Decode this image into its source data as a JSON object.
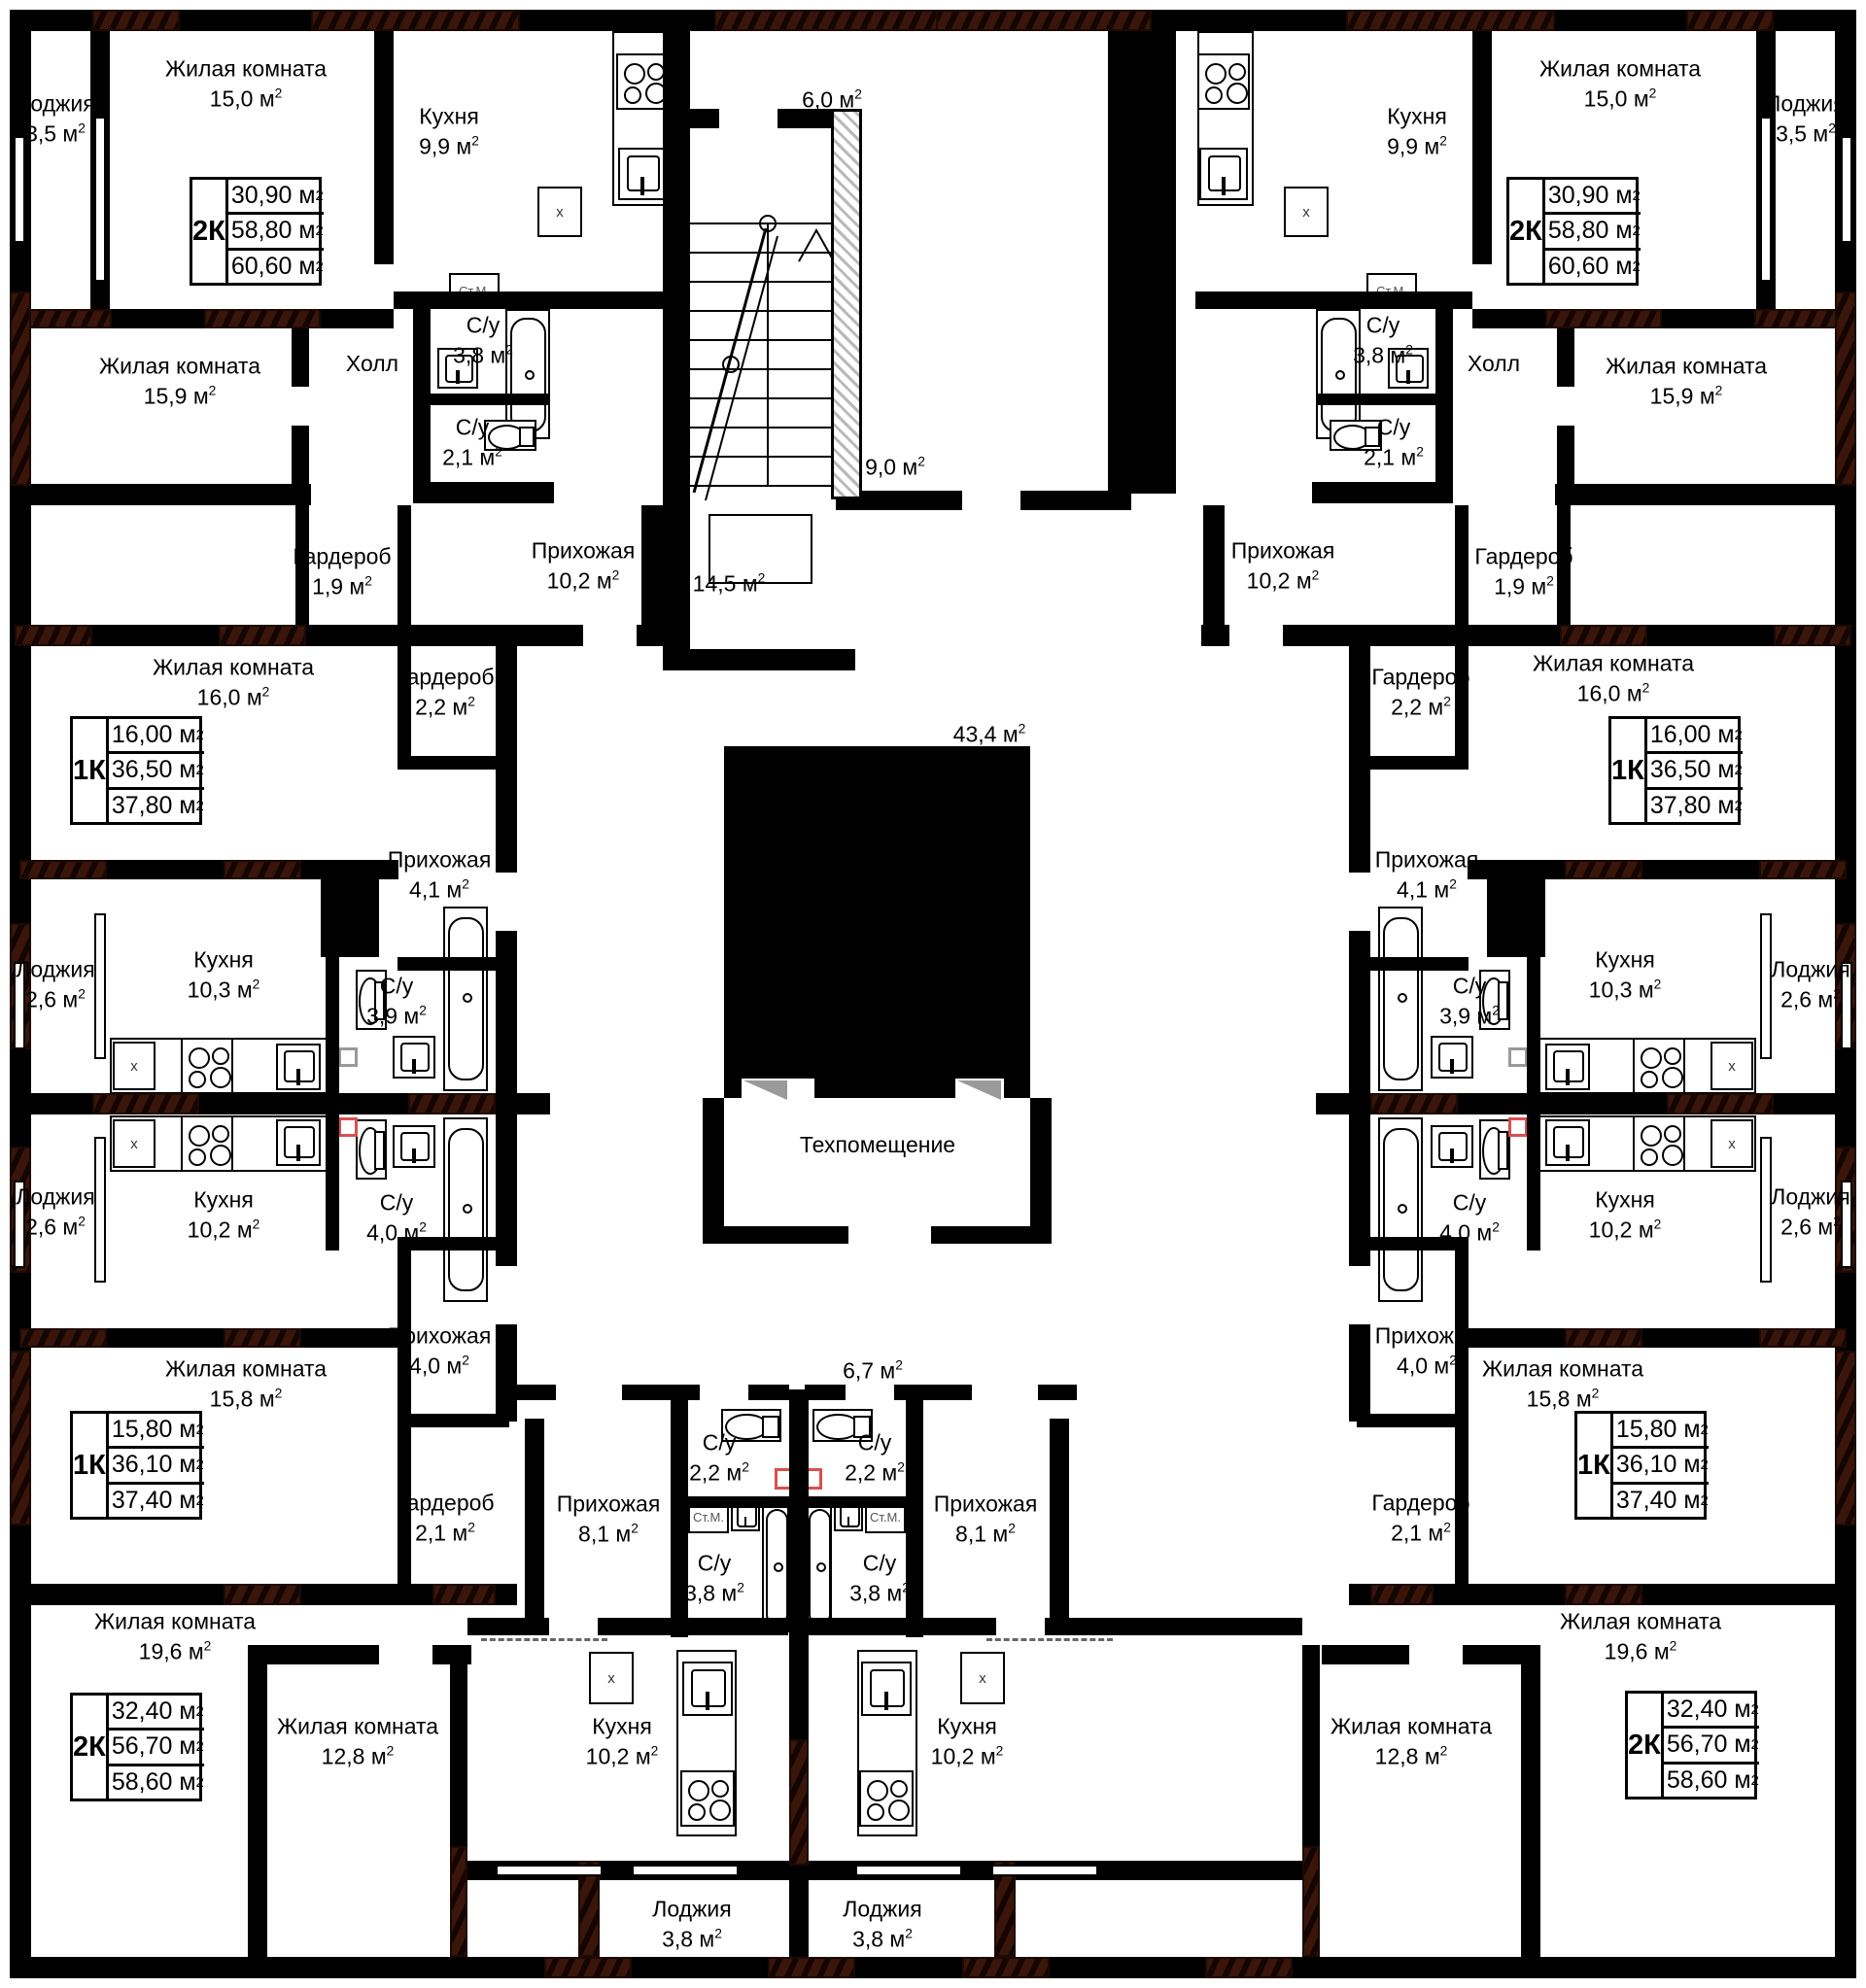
{
  "plan": {
    "fixture_labels": {
      "washing_machine": "Ст.М.",
      "appliance_mark": "x"
    },
    "colors": {
      "wall": "#000000",
      "hatch": "#3a150a",
      "red_highlight": "#d94f4f",
      "paper": "#ffffff"
    },
    "rooms": {
      "tl_loggia": {
        "name": "Лоджия",
        "area": "3,5 м²"
      },
      "tl_living1": {
        "name": "Жилая комната",
        "area": "15,0 м²"
      },
      "tl_kitchen": {
        "name": "Кухня",
        "area": "9,9 м²"
      },
      "tl_living2": {
        "name": "Жилая комната",
        "area": "15,9 м²"
      },
      "tl_hall": {
        "name": "Холл",
        "area": ""
      },
      "tl_su38": {
        "name": "С/у",
        "area": "3,8 м²"
      },
      "tl_su21": {
        "name": "С/у",
        "area": "2,1 м²"
      },
      "tl_garderob": {
        "name": "Гардероб",
        "area": "1,9 м²"
      },
      "tl_prihozhaya": {
        "name": "Прихожая",
        "area": "10,2 м²"
      },
      "ml_living": {
        "name": "Жилая комната",
        "area": "16,0 м²"
      },
      "ml_garderob": {
        "name": "Гардероб",
        "area": "2,2 м²"
      },
      "ml_prihozhaya": {
        "name": "Прихожая",
        "area": "4,1 м²"
      },
      "ml_loggia_a": {
        "name": "Лоджия",
        "area": "2,6 м²"
      },
      "ml_kitchen_a": {
        "name": "Кухня",
        "area": "10,3 м²"
      },
      "ml_su39": {
        "name": "С/у",
        "area": "3,9 м²"
      },
      "ml_loggia_b": {
        "name": "Лоджия",
        "area": "2,6 м²"
      },
      "ml_kitchen_b": {
        "name": "Кухня",
        "area": "10,2 м²"
      },
      "ml_su40": {
        "name": "С/у",
        "area": "4,0 м²"
      },
      "bl_prihozhaya40": {
        "name": "Прихожая",
        "area": "4,0 м²"
      },
      "bl_living158": {
        "name": "Жилая комната",
        "area": "15,8 м²"
      },
      "bl_garderob21": {
        "name": "Гардероб",
        "area": "2,1 м²"
      },
      "bl_living196": {
        "name": "Жилая комната",
        "area": "19,6 м²"
      },
      "bl_living128": {
        "name": "Жилая комната",
        "area": "12,8 м²"
      },
      "bl_kitchen102": {
        "name": "Кухня",
        "area": "10,2 м²"
      },
      "bl_prihozhaya81": {
        "name": "Прихожая",
        "area": "8,1 м²"
      },
      "bl_su22": {
        "name": "С/у",
        "area": "2,2 м²"
      },
      "bl_su38": {
        "name": "С/у",
        "area": "3,8 м²"
      },
      "bl_loggia38": {
        "name": "Лоджия",
        "area": "3,8 м²"
      },
      "c_60": {
        "name": "",
        "area": "6,0 м²"
      },
      "c_90": {
        "name": "",
        "area": "9,0 м²"
      },
      "c_145": {
        "name": "",
        "area": "14,5 м²"
      },
      "c_434": {
        "name": "",
        "area": "43,4 м²"
      },
      "c_tech": {
        "name": "Техпомещение",
        "area": ""
      },
      "c_67": {
        "name": "",
        "area": "6,7 м²"
      },
      "tr_kitchen": {
        "name": "Кухня",
        "area": "9,9 м²"
      },
      "tr_living1": {
        "name": "Жилая комната",
        "area": "15,0 м²"
      },
      "tr_loggia": {
        "name": "Лоджия",
        "area": "3,5 м²"
      },
      "tr_su38": {
        "name": "С/у",
        "area": "3,8 м²"
      },
      "tr_su21": {
        "name": "С/у",
        "area": "2,1 м²"
      },
      "tr_hall": {
        "name": "Холл",
        "area": ""
      },
      "tr_living2": {
        "name": "Жилая комната",
        "area": "15,9 м²"
      },
      "tr_prihozhaya": {
        "name": "Прихожая",
        "area": "10,2 м²"
      },
      "tr_garderob": {
        "name": "Гардероб",
        "area": "1,9 м²"
      },
      "mr_garderob": {
        "name": "Гардероб",
        "area": "2,2 м²"
      },
      "mr_living": {
        "name": "Жилая комната",
        "area": "16,0 м²"
      },
      "mr_prihozhaya": {
        "name": "Прихожая",
        "area": "4,1 м²"
      },
      "mr_su39": {
        "name": "С/у",
        "area": "3,9 м²"
      },
      "mr_kitchen_a": {
        "name": "Кухня",
        "area": "10,3 м²"
      },
      "mr_loggia_a": {
        "name": "Лоджия",
        "area": "2,6 м²"
      },
      "mr_su40": {
        "name": "С/у",
        "area": "4,0 м²"
      },
      "mr_kitchen_b": {
        "name": "Кухня",
        "area": "10,2 м²"
      },
      "mr_loggia_b": {
        "name": "Лоджия",
        "area": "2,6 м²"
      },
      "br_prihozhaya40": {
        "name": "Прихожая",
        "area": "4,0 м²"
      },
      "br_living158": {
        "name": "Жилая комната",
        "area": "15,8 м²"
      },
      "br_garderob21": {
        "name": "Гардероб",
        "area": "2,1 м²"
      },
      "br_living196": {
        "name": "Жилая комната",
        "area": "19,6 м²"
      },
      "br_living128": {
        "name": "Жилая комната",
        "area": "12,8 м²"
      },
      "br_kitchen102": {
        "name": "Кухня",
        "area": "10,2 м²"
      },
      "br_prihozhaya81": {
        "name": "Прихожая",
        "area": "8,1 м²"
      },
      "br_su22": {
        "name": "С/у",
        "area": "2,2 м²"
      },
      "br_su38": {
        "name": "С/у",
        "area": "3,8 м²"
      },
      "br_loggia38": {
        "name": "Лоджия",
        "area": "3,8 м²"
      }
    },
    "apartments": {
      "tl2k": {
        "type": "2К",
        "areas": [
          "30,90 м²",
          "58,80 м²",
          "60,60 м²"
        ]
      },
      "tr2k": {
        "type": "2К",
        "areas": [
          "30,90 м²",
          "58,80 м²",
          "60,60 м²"
        ]
      },
      "ml1k": {
        "type": "1К",
        "areas": [
          "16,00 м²",
          "36,50 м²",
          "37,80 м²"
        ]
      },
      "mr1k": {
        "type": "1К",
        "areas": [
          "16,00 м²",
          "36,50 м²",
          "37,80 м²"
        ]
      },
      "bl1k": {
        "type": "1К",
        "areas": [
          "15,80 м²",
          "36,10 м²",
          "37,40 м²"
        ]
      },
      "br1k": {
        "type": "1К",
        "areas": [
          "15,80 м²",
          "36,10 м²",
          "37,40 м²"
        ]
      },
      "bl2k": {
        "type": "2К",
        "areas": [
          "32,40 м²",
          "56,70 м²",
          "58,60 м²"
        ]
      },
      "br2k": {
        "type": "2К",
        "areas": [
          "32,40 м²",
          "56,70 м²",
          "58,60 м²"
        ]
      }
    }
  }
}
